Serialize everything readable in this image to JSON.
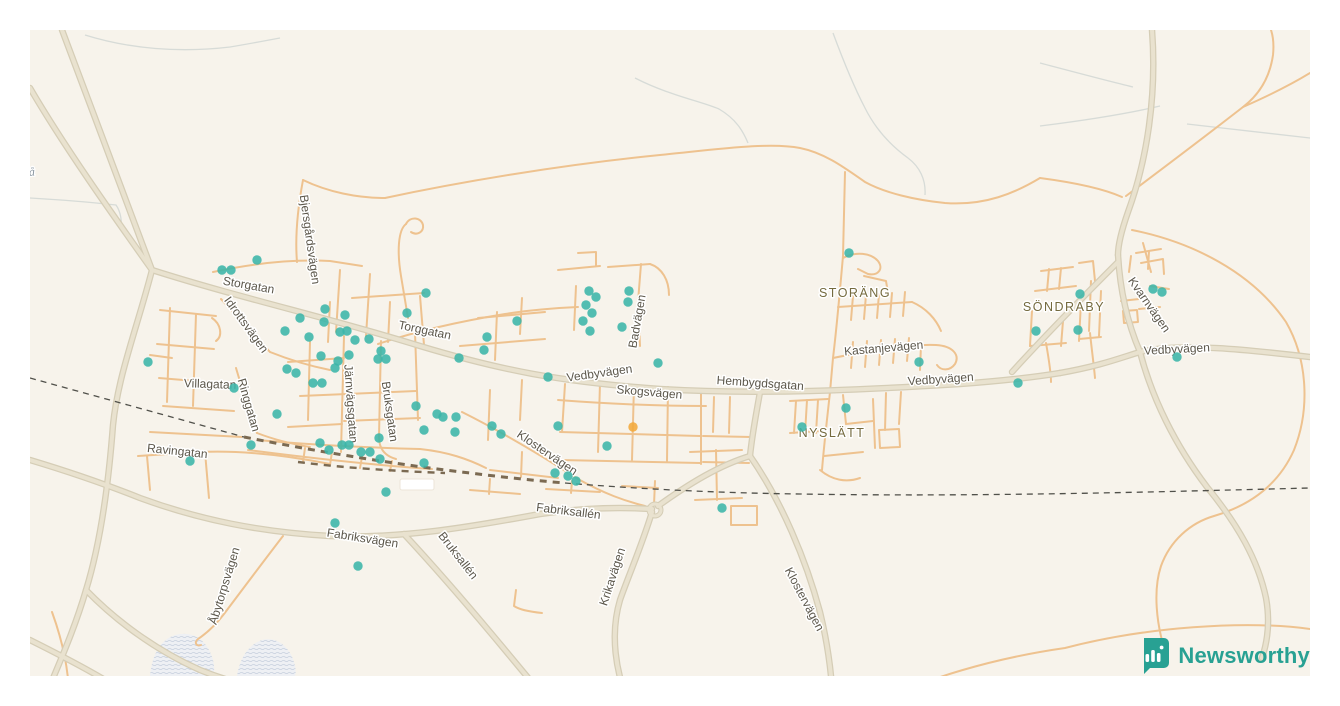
{
  "logo": {
    "text": "Newsworthy",
    "brand_color": "#28a193",
    "icon": "newsworthy-chart-pin-icon"
  },
  "map": {
    "background_color": "#f7f3eb",
    "minor_road_color": "#eec28f",
    "major_road_color": "#e9e2cf",
    "marker_color_teal": "#3bb5a9",
    "marker_color_orange": "#f2a93b",
    "street_labels": [
      {
        "text": "Storgatan",
        "x": 248,
        "y": 289,
        "rotate": 10
      },
      {
        "text": "Idrottsvägen",
        "x": 243,
        "y": 327,
        "rotate": 54
      },
      {
        "text": "Bjersgårdsvägen",
        "x": 306,
        "y": 240,
        "rotate": 82
      },
      {
        "text": "Villagatan",
        "x": 210,
        "y": 388,
        "rotate": 2
      },
      {
        "text": "Ringgatan",
        "x": 245,
        "y": 406,
        "rotate": 74
      },
      {
        "text": "Järnvägsgatan",
        "x": 347,
        "y": 404,
        "rotate": 86
      },
      {
        "text": "Bruksgatan",
        "x": 386,
        "y": 412,
        "rotate": 82
      },
      {
        "text": "Torggatan",
        "x": 424,
        "y": 334,
        "rotate": 12
      },
      {
        "text": "Ravingatan",
        "x": 177,
        "y": 455,
        "rotate": 6
      },
      {
        "text": "Åbytorpsvägen",
        "x": 228,
        "y": 587,
        "rotate": -73
      },
      {
        "text": "Fabriksvägen",
        "x": 362,
        "y": 542,
        "rotate": 9
      },
      {
        "text": "Fabriksallén",
        "x": 568,
        "y": 515,
        "rotate": 7
      },
      {
        "text": "Bruksallén",
        "x": 455,
        "y": 558,
        "rotate": 52
      },
      {
        "text": "Krikavägen",
        "x": 616,
        "y": 578,
        "rotate": -72
      },
      {
        "text": "Klostervägen",
        "x": 545,
        "y": 456,
        "rotate": 34
      },
      {
        "text": "Klostervägen",
        "x": 801,
        "y": 601,
        "rotate": 62
      },
      {
        "text": "Vedbyvägen",
        "x": 600,
        "y": 377,
        "rotate": -8
      },
      {
        "text": "Skogsvägen",
        "x": 649,
        "y": 396,
        "rotate": 5
      },
      {
        "text": "Hembygdsgatan",
        "x": 760,
        "y": 387,
        "rotate": 4
      },
      {
        "text": "Badvägen",
        "x": 641,
        "y": 322,
        "rotate": -80
      },
      {
        "text": "Vedbyvägen",
        "x": 941,
        "y": 383,
        "rotate": -4
      },
      {
        "text": "Kastanjevägen",
        "x": 884,
        "y": 352,
        "rotate": -5
      },
      {
        "text": "Vedbyvägen",
        "x": 1177,
        "y": 353,
        "rotate": -3
      },
      {
        "text": "Kvarnvägen",
        "x": 1146,
        "y": 307,
        "rotate": 55
      }
    ],
    "area_labels": [
      {
        "text": "STORÄNG",
        "x": 855,
        "y": 297
      },
      {
        "text": "SÖNDRABY",
        "x": 1064,
        "y": 311
      },
      {
        "text": "NYSLÄTT",
        "x": 832,
        "y": 437
      }
    ],
    "water_labels": [
      {
        "text": "e å",
        "x": 28,
        "y": 176,
        "rotate": -4
      }
    ],
    "markers": {
      "teal": [
        [
          222,
          270
        ],
        [
          231,
          270
        ],
        [
          257,
          260
        ],
        [
          148,
          362
        ],
        [
          426,
          293
        ],
        [
          325,
          309
        ],
        [
          300,
          318
        ],
        [
          345,
          315
        ],
        [
          324,
          322
        ],
        [
          407,
          313
        ],
        [
          285,
          331
        ],
        [
          340,
          332
        ],
        [
          347,
          331
        ],
        [
          309,
          337
        ],
        [
          355,
          340
        ],
        [
          369,
          339
        ],
        [
          381,
          351
        ],
        [
          378,
          359
        ],
        [
          386,
          359
        ],
        [
          321,
          356
        ],
        [
          338,
          361
        ],
        [
          349,
          355
        ],
        [
          335,
          368
        ],
        [
          287,
          369
        ],
        [
          296,
          373
        ],
        [
          313,
          383
        ],
        [
          322,
          383
        ],
        [
          234,
          388
        ],
        [
          277,
          414
        ],
        [
          251,
          445
        ],
        [
          190,
          461
        ],
        [
          320,
          443
        ],
        [
          329,
          450
        ],
        [
          342,
          445
        ],
        [
          349,
          445
        ],
        [
          361,
          452
        ],
        [
          370,
          452
        ],
        [
          379,
          438
        ],
        [
          380,
          459
        ],
        [
          424,
          463
        ],
        [
          455,
          432
        ],
        [
          386,
          492
        ],
        [
          416,
          406
        ],
        [
          437,
          414
        ],
        [
          443,
          417
        ],
        [
          456,
          417
        ],
        [
          424,
          430
        ],
        [
          492,
          426
        ],
        [
          501,
          434
        ],
        [
          589,
          291
        ],
        [
          596,
          297
        ],
        [
          586,
          305
        ],
        [
          592,
          313
        ],
        [
          583,
          321
        ],
        [
          590,
          331
        ],
        [
          629,
          291
        ],
        [
          628,
          302
        ],
        [
          622,
          327
        ],
        [
          517,
          321
        ],
        [
          487,
          337
        ],
        [
          484,
          350
        ],
        [
          459,
          358
        ],
        [
          548,
          377
        ],
        [
          658,
          363
        ],
        [
          558,
          426
        ],
        [
          607,
          446
        ],
        [
          555,
          473
        ],
        [
          568,
          476
        ],
        [
          576,
          481
        ],
        [
          722,
          508
        ],
        [
          358,
          566
        ],
        [
          335,
          523
        ],
        [
          849,
          253
        ],
        [
          919,
          362
        ],
        [
          846,
          408
        ],
        [
          802,
          427
        ],
        [
          1018,
          383
        ],
        [
          1080,
          294
        ],
        [
          1036,
          331
        ],
        [
          1078,
          330
        ],
        [
          1153,
          289
        ],
        [
          1162,
          292
        ],
        [
          1177,
          357
        ]
      ],
      "orange": [
        [
          633,
          427
        ]
      ]
    }
  }
}
